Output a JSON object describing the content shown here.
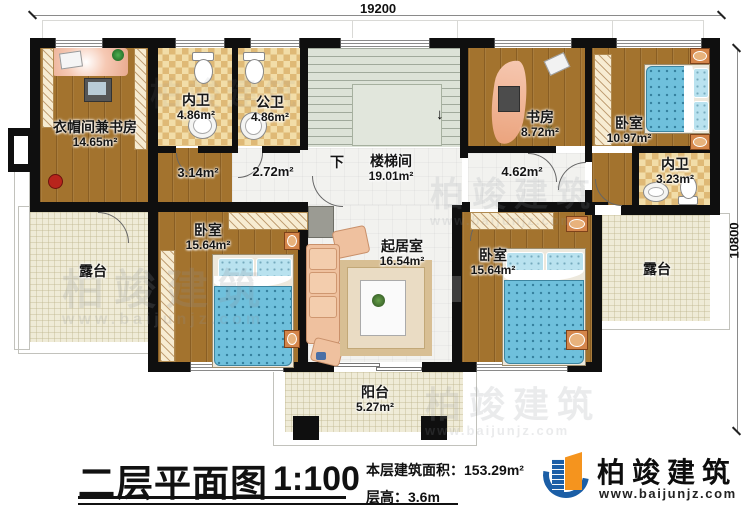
{
  "dimensions": {
    "top": "19200",
    "right": "10800"
  },
  "stairs": {
    "down_label": "下",
    "arrow": "↓"
  },
  "rooms": {
    "cloakroom": {
      "name": "衣帽间兼书房",
      "area": "14.65m²"
    },
    "bath_left": {
      "name": "内卫",
      "area": "4.86m²"
    },
    "bath_public": {
      "name": "公卫",
      "area": "4.86m²"
    },
    "stairwell": {
      "name": "楼梯间",
      "area": "19.01m²"
    },
    "corridor_left": {
      "area": "3.14m²"
    },
    "corridor_mid": {
      "area": "2.72m²"
    },
    "corridor_right": {
      "area": "4.62m²"
    },
    "study": {
      "name": "书房",
      "area": "8.72m²"
    },
    "bedroom_top_right": {
      "name": "卧室",
      "area": "10.97m²"
    },
    "bath_right": {
      "name": "内卫",
      "area": "3.23m²"
    },
    "bedroom_left": {
      "name": "卧室",
      "area": "15.64m²"
    },
    "living_room": {
      "name": "起居室",
      "area": "16.54m²"
    },
    "bedroom_right": {
      "name": "卧室",
      "area": "15.64m²"
    },
    "terrace_left": {
      "name": "露台"
    },
    "terrace_right": {
      "name": "露台"
    },
    "balcony": {
      "name": "阳台",
      "area": "5.27m²"
    }
  },
  "title_block": {
    "title": "二层平面图",
    "scale": "1:100",
    "floor_area": "本层建筑面积：153.29m²",
    "floor_height": "层高：3.6m"
  },
  "logo": {
    "name": "柏竣建筑",
    "website": "www.baijunjz.com"
  },
  "watermark": {
    "brand": "柏竣建筑",
    "website": "www.baijunjz.com"
  },
  "colors": {
    "logo_blue": "#1b5ea6",
    "logo_orange": "#f5941e",
    "wall": "#0f0f0f"
  }
}
